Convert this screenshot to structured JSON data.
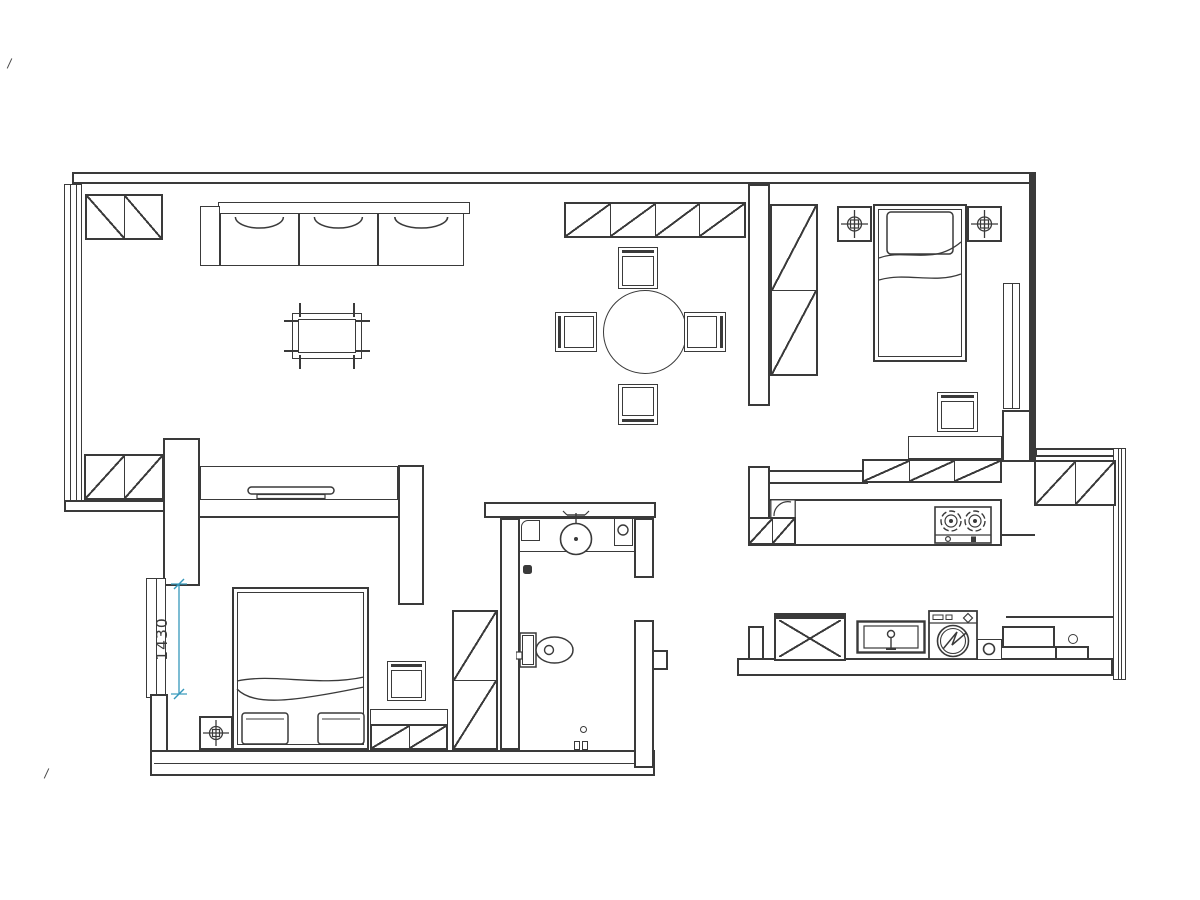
{
  "drawing": {
    "type": "residential-floor-plan",
    "dimension_label": "1430",
    "colors": {
      "line": "#3a3a3a",
      "dimension": "#3598bb",
      "background": "#ffffff"
    },
    "items": [
      "entry-cabinet",
      "sofa",
      "coffee-table",
      "tv-cabinet",
      "tv",
      "bay-window-cabinet",
      "dining-sideboard",
      "dining-table",
      "dining-chair-north",
      "dining-chair-south",
      "dining-chair-west",
      "dining-chair-east",
      "hall-wardrobe",
      "bedroom2-bed",
      "bedroom2-nightstand-left",
      "bedroom2-nightstand-right",
      "bedroom2-chair",
      "bedroom2-desk",
      "bedroom2-cabinet-row",
      "bedroom2-window",
      "kitchen-counter",
      "gas-stove",
      "kitchen-corner-unit",
      "kitchen-base-cabinet",
      "balcony-cabinet",
      "ac-unit",
      "laundry-sink",
      "washing-machine",
      "floor-drain-box",
      "floor-drain",
      "bathroom-vanity",
      "wash-basin",
      "toilet",
      "shower-fittings",
      "bedroom1-bed",
      "bedroom1-nightstand",
      "bedroom1-chair",
      "bedroom1-dresser",
      "bedroom1-wardrobe",
      "bedroom1-window",
      "dimension-line"
    ]
  }
}
